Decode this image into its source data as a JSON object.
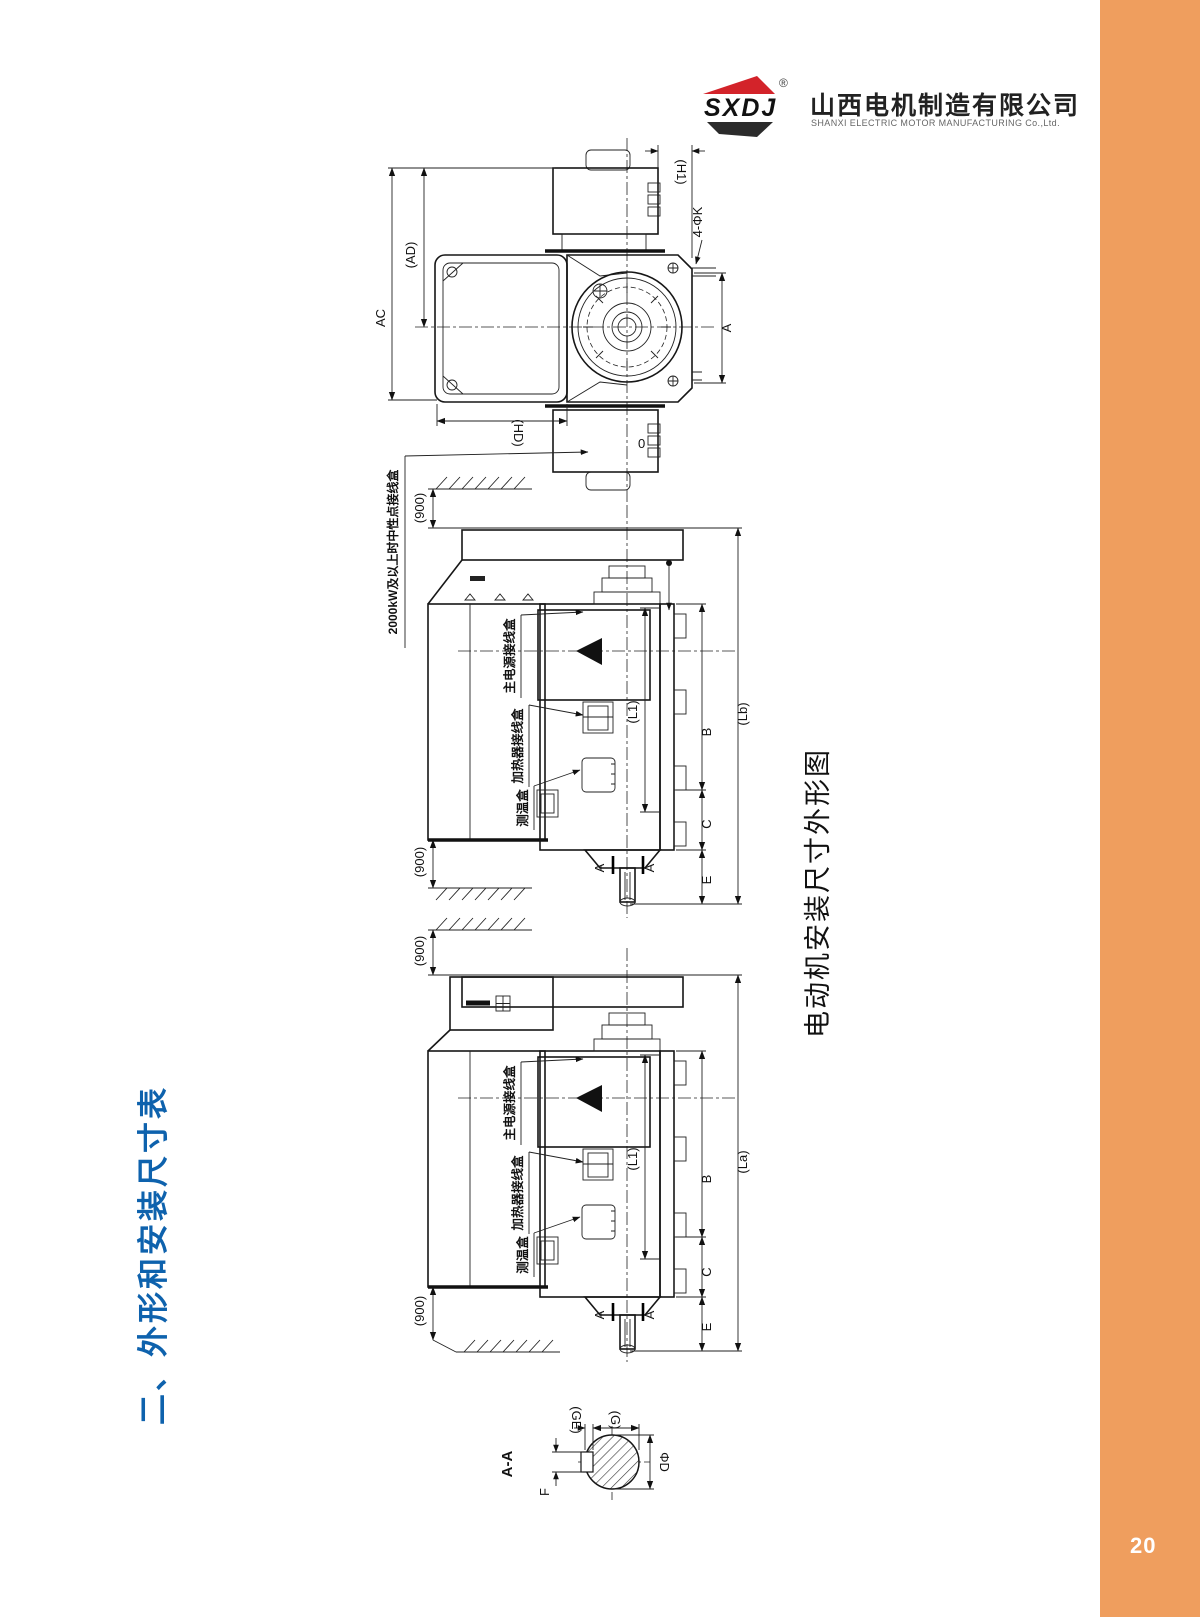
{
  "page": {
    "number": "20"
  },
  "brand": {
    "logo_text": "SXDJ",
    "reg_mark": "®",
    "company_cn": "山西电机制造有限公司",
    "company_en": "SHANXI ELECTRIC MOTOR MANUFACTURING Co.,Ltd."
  },
  "section_title": "二、外形和安装尺寸表",
  "figure_caption": "电动机安装尺寸外形图",
  "end_view": {
    "dim_ac": "AC",
    "dim_ad": "(AD)",
    "dim_hd": "(HD)",
    "dim_h1": "(H1)",
    "dim_k_holes": "4-ΦK",
    "dim_a": "A",
    "port_zero": "0"
  },
  "side_view_lb": {
    "note_neutral_box": "2000kW及以上时中性点接线盒",
    "label_main_terminal_box": "主电源接线盒",
    "label_heater_terminal_box": "加热器接线盒",
    "label_temp_box": "测温盒",
    "dim_900_top": "(900)",
    "dim_900_bottom": "(900)",
    "dim_l1": "(L1)",
    "dim_b": "B",
    "dim_c": "C",
    "dim_e": "E",
    "dim_lb": "(Lb)",
    "section_mark_a": "A"
  },
  "side_view_la": {
    "label_main_terminal_box": "主电源接线盒",
    "label_heater_terminal_box": "加热器接线盒",
    "label_temp_box": "测温盒",
    "dim_900_top": "(900)",
    "dim_900_bottom": "(900)",
    "dim_l1": "(L1)",
    "dim_b": "B",
    "dim_c": "C",
    "dim_e": "E",
    "dim_la": "(La)",
    "section_mark_a": "A"
  },
  "section_aa": {
    "title": "A-A",
    "dim_f": "F",
    "dim_ge": "(GE)",
    "dim_g": "(G)",
    "dim_d": "ΦD"
  },
  "colors": {
    "accent_orange": "#ef9e5e",
    "title_blue": "#0e62ad",
    "logo_red": "#d3232a",
    "line_ink": "#1c1c1c"
  }
}
